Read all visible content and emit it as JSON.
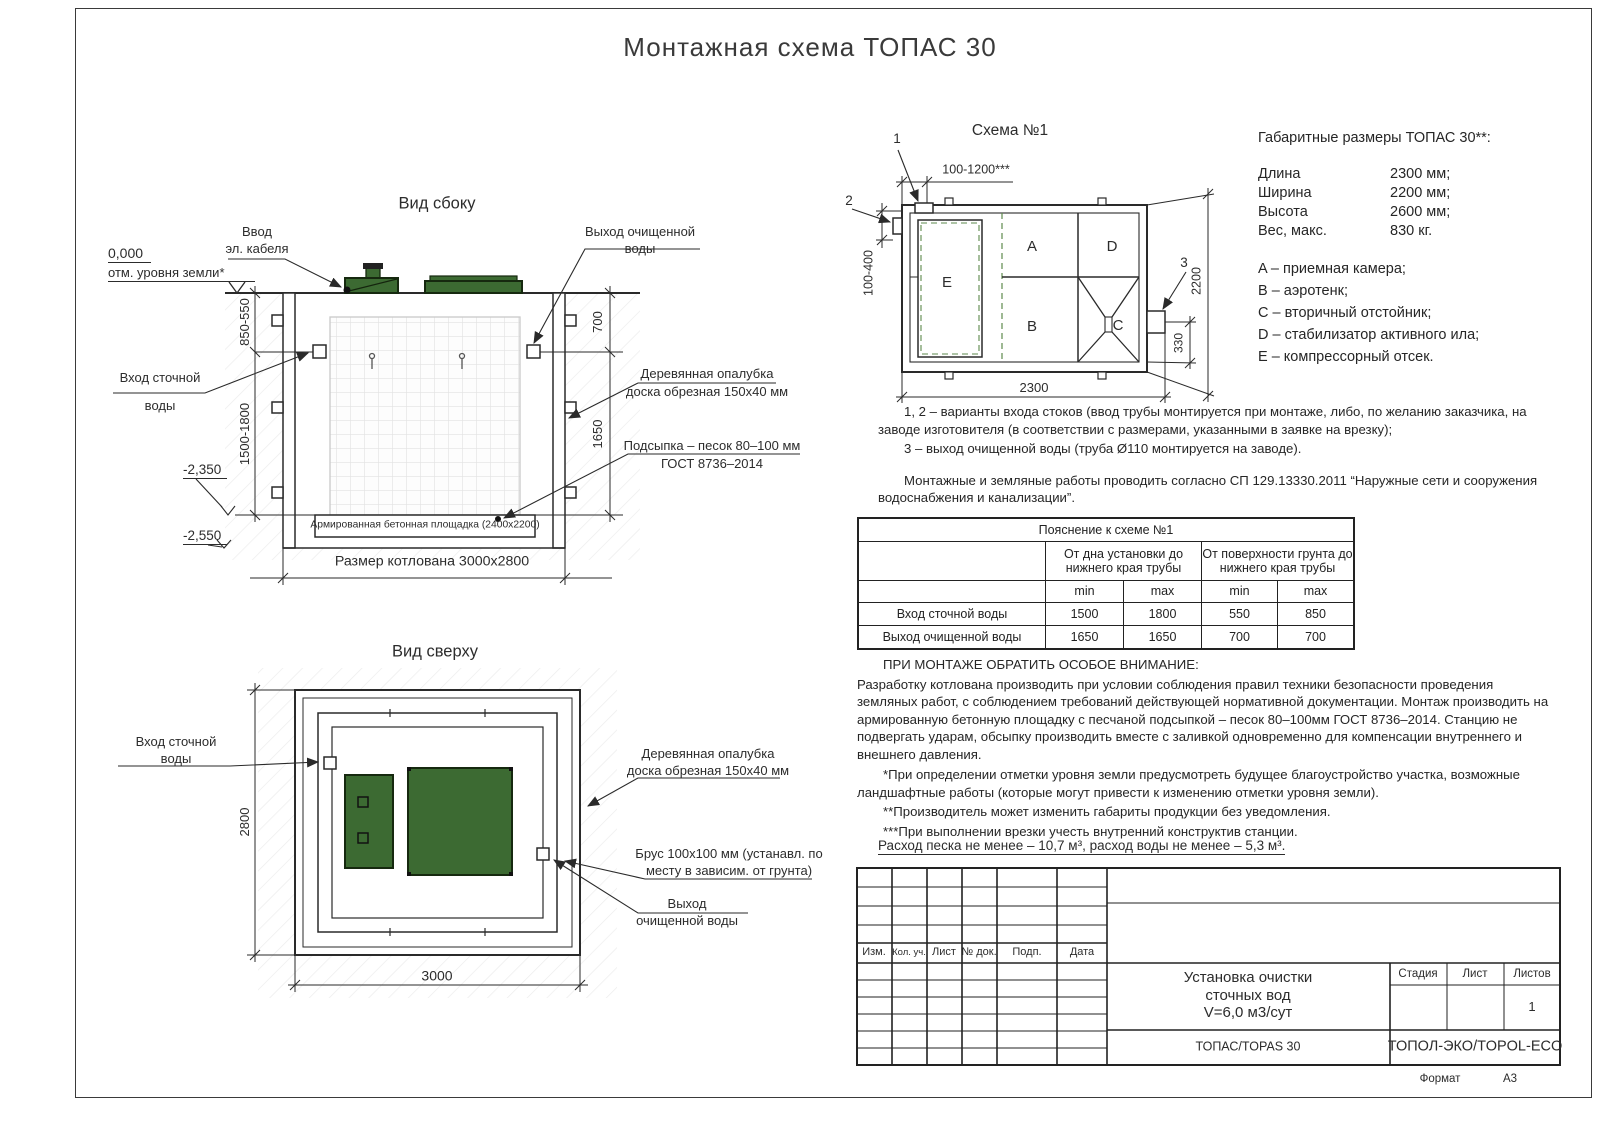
{
  "page": {
    "title": "Монтажная схема ТОПАС 30",
    "format_label": "Формат",
    "format_value": "А3"
  },
  "colors": {
    "line": "#2a2a2a",
    "green": "#3c6a32",
    "green_dark": "#16290f",
    "dashed_green": "#5d8a4c",
    "grid": "#e3e3e3"
  },
  "side_view": {
    "title": "Вид сбоку",
    "zero_mark": "0,000",
    "ground_note": "отм. уровня земли*",
    "cable_1": "Ввод",
    "cable_2": "эл. кабеля",
    "clean_out_1": "Выход очищенной",
    "clean_out_2": "воды",
    "inlet_1": "Вход сточной",
    "inlet_2": "воды",
    "formwork_1": "Деревянная опалубка",
    "formwork_2": "доска обрезная 150x40 мм",
    "sand_1": "Подсыпка – песок 80–100 мм",
    "sand_2": "ГОСТ 8736–2014",
    "slab": "Армированная бетонная площадка (2400x2200)",
    "pit_size": "Размер котлована 3000x2800",
    "elev_1": "-2,350",
    "elev_2": "-2,550",
    "dim_850": "850-550",
    "dim_1500": "1500-1800",
    "dim_700": "700",
    "dim_1650": "1650"
  },
  "top_view": {
    "title": "Вид сверху",
    "inlet_1": "Вход сточной",
    "inlet_2": "воды",
    "formwork_1": "Деревянная опалубка",
    "formwork_2": "доска обрезная 150x40 мм",
    "timber_1": "Брус 100x100 мм (устанавл. по",
    "timber_2": "месту в зависим. от грунта)",
    "outlet_1": "Выход",
    "outlet_2": "очищенной воды",
    "dim_2800": "2800",
    "dim_3000": "3000"
  },
  "schema": {
    "title": "Схема №1",
    "callout_1": "1",
    "callout_2": "2",
    "callout_3": "3",
    "comp_a": "A",
    "comp_b": "B",
    "comp_c": "C",
    "comp_d": "D",
    "comp_e": "E",
    "dim_top": "100-1200***",
    "dim_left": "100-400",
    "dim_right": "2200",
    "dim_outlet": "330",
    "dim_bottom": "2300"
  },
  "specs": {
    "title": "Габаритные размеры ТОПАС 30**:",
    "rows": [
      {
        "label": "Длина",
        "value": "2300 мм;"
      },
      {
        "label": "Ширина",
        "value": "2200 мм;"
      },
      {
        "label": "Высота",
        "value": "2600 мм;"
      },
      {
        "label": "Вес, макс.",
        "value": "830 кг."
      }
    ],
    "legend": [
      "A – приемная камера;",
      "B – аэротенк;",
      "C – вторичный отстойник;",
      "D – стабилизатор активного ила;",
      "E – компрессорный отсек."
    ]
  },
  "notes": {
    "variants_1": "1, 2 – варианты входа  стоков (ввод трубы монтируется при монтаже, либо, по желанию заказчика, на заводе изготовителя (в соответствии с размерами, указанными в заявке на врезку);",
    "variants_2": "3 – выход очищенной воды (труба Ø110 монтируется на заводе).",
    "sp": "Монтажные и земляные работы проводить согласно СП 129.13330.2011 “Наружные сети и сооружения водоснабжения и канализации”."
  },
  "table": {
    "title": "Пояснение к схеме №1",
    "group_1": "От дна установки до нижнего края трубы",
    "group_2": "От поверхности грунта до нижнего края трубы",
    "min": "min",
    "max": "max",
    "rows": [
      {
        "label": "Вход сточной воды",
        "v1": "1500",
        "v2": "1800",
        "v3": "550",
        "v4": "850"
      },
      {
        "label": "Выход очищенной воды",
        "v1": "1650",
        "v2": "1650",
        "v3": "700",
        "v4": "700"
      }
    ]
  },
  "attention": {
    "heading": "ПРИ МОНТАЖЕ ОБРАТИТЬ ОСОБОЕ ВНИМАНИЕ:",
    "body": "Разработку котлована производить при условии соблюдения правил техники безопасности проведения земляных работ, с соблюдением требований действующей нормативной документации.  Монтаж производить на армированную бетонную площадку с песчаной подсыпкой – песок 80–100мм ГОСТ 8736–2014. Станцию не подвергать ударам, обсыпку производить вместе с заливкой одновременно для компенсации внутреннего и внешнего давления.",
    "fn1": "*При определении отметки уровня земли предусмотреть будущее благоустройство участка, возможные ландшафтные работы (которые могут привести к изменению отметки уровня земли).",
    "fn2": "**Производитель может изменить габариты продукции без уведомления.",
    "fn3": "***При выполнении врезки учесть внутренний конструктив станции.",
    "consumption": "Расход песка не менее – 10,7 м³, расход воды не менее – 5,3 м³."
  },
  "stamp": {
    "cols": [
      "Изм.",
      "Кол. уч.",
      "Лист",
      "№ док.",
      "Подп.",
      "Дата"
    ],
    "product_1": "Установка очистки",
    "product_2": "сточных вод",
    "product_3": "V=6,0 м3/сут",
    "model": "ТОПАС/TOPAS 30",
    "stage": "Стадия",
    "sheet": "Лист",
    "sheets": "Листов",
    "sheets_value": "1",
    "brand": "ТОПОЛ-ЭКО/TOPOL-ECO"
  }
}
